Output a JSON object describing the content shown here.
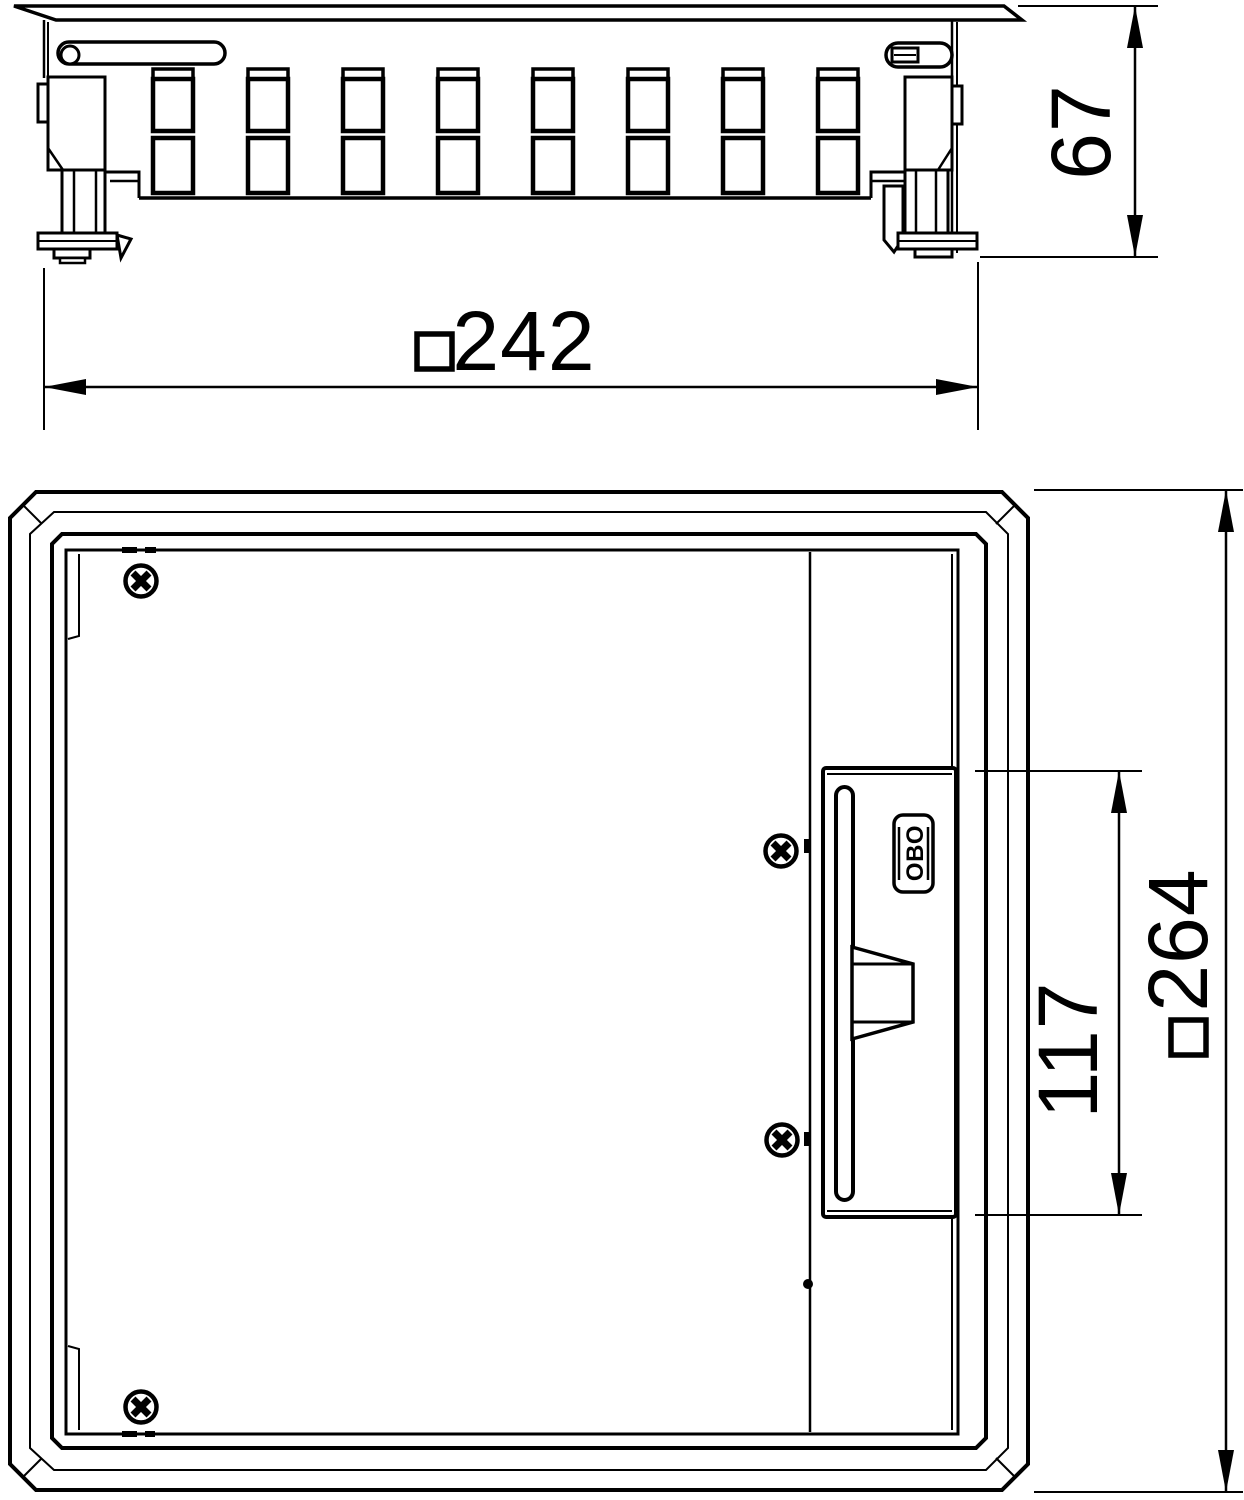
{
  "drawing": {
    "background_color": "#ffffff",
    "line_color": "#000000",
    "views": {
      "side": {
        "id": "side-elevation"
      },
      "plan": {
        "id": "plan-view"
      }
    }
  },
  "dimensions": {
    "height_67": {
      "label": "67"
    },
    "width_242": {
      "label": "□242",
      "digits": "242"
    },
    "lid_117": {
      "label": "117"
    },
    "outer_264": {
      "label": "□264",
      "digits": "264"
    }
  },
  "logo": {
    "label": "OBO"
  }
}
